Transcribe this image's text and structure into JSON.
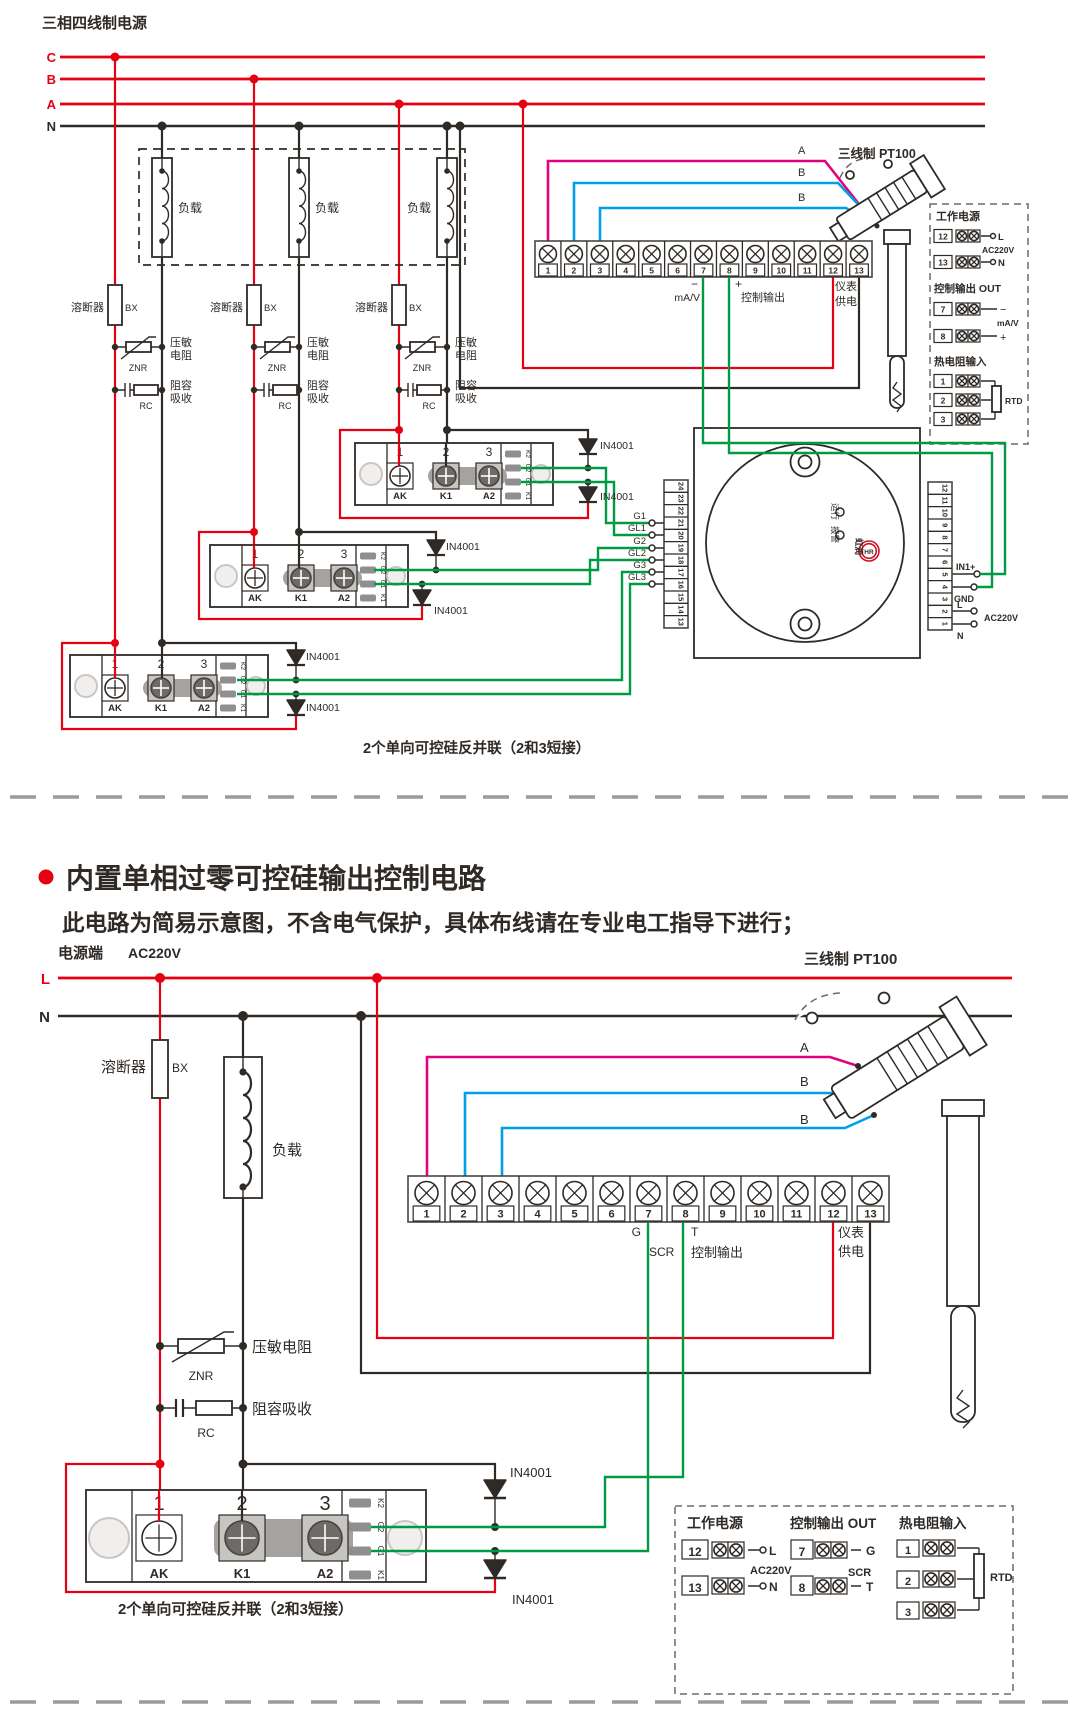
{
  "colors": {
    "red": "#e60012",
    "magenta": "#e4007f",
    "blue": "#00a0e9",
    "green": "#009a44",
    "ink": "#2f2a26"
  },
  "top": {
    "title": "三相四线制电源",
    "phase_c": "C",
    "phase_b": "B",
    "phase_a": "A",
    "neutral": "N",
    "load": "负载",
    "fuse": "溶断器",
    "fuse_code": "BX",
    "znr1": "压敏",
    "znr2": "电阻",
    "znr_code": "ZNR",
    "rc1": "阻容",
    "rc2": "吸收",
    "rc_code": "RC",
    "diode": "IN4001",
    "module_numbers": [
      "1",
      "2",
      "3"
    ],
    "module_names": [
      "AK",
      "K1",
      "A2"
    ],
    "module_side": [
      "K2",
      "G2",
      "G1",
      "K1"
    ],
    "strip_numbers": [
      "1",
      "2",
      "3",
      "4",
      "5",
      "6",
      "7",
      "8",
      "9",
      "10",
      "11",
      "12",
      "13"
    ],
    "minus": "−",
    "plus": "+",
    "ma_v": "mA/V",
    "control_out": "控制输出",
    "meter1": "仪表",
    "meter2": "供电",
    "wire_a": "A",
    "wire_b1": "B",
    "wire_b2": "B",
    "sensor": "三线制 PT100",
    "gates": [
      "G1",
      "GL1",
      "G2",
      "GL2",
      "G3",
      "GL3"
    ],
    "ctl_left": [
      "24",
      "23",
      "22",
      "21",
      "20",
      "19",
      "18",
      "17",
      "16",
      "15",
      "14",
      "13"
    ],
    "ctl_right": [
      "12",
      "11",
      "10",
      "9",
      "8",
      "7",
      "6",
      "5",
      "4",
      "3",
      "2",
      "1"
    ],
    "run": "运行",
    "alarm": "报警",
    "brand": "虹润",
    "brand_logo": "HR",
    "in1": "IN1+",
    "gnd": "GND",
    "l": "L",
    "ac220": "AC220V",
    "n": "N",
    "panel": {
      "power": "工作电源",
      "out": "控制输出 OUT",
      "rtd_in": "热电阻输入",
      "n12": "12",
      "n13": "13",
      "n7": "7",
      "n8": "8",
      "r1": "1",
      "r2": "2",
      "r3": "3",
      "l": "L",
      "n": "N",
      "ac": "AC220V",
      "minus": "−",
      "plus": "+",
      "ma_v": "mA/V",
      "rtd": "RTD"
    },
    "caption": "2个单向可控硅反并联（2和3短接）"
  },
  "middle": {
    "heading": "内置单相过零可控硅输出控制电路",
    "note": "此电路为简易示意图，不含电气保护，具体布线请在专业电工指导下进行；"
  },
  "bottom": {
    "source": "电源端",
    "voltage": "AC220V",
    "line_l": "L",
    "line_n": "N",
    "fuse": "溶断器",
    "fuse_code": "BX",
    "load": "负载",
    "znr": "压敏电阻",
    "znr_code": "ZNR",
    "rc": "阻容吸收",
    "rc_code": "RC",
    "strip_numbers": [
      "1",
      "2",
      "3",
      "4",
      "5",
      "6",
      "7",
      "8",
      "9",
      "10",
      "11",
      "12",
      "13"
    ],
    "g": "G",
    "scr": "SCR",
    "t": "T",
    "control_out": "控制输出",
    "meter1": "仪表",
    "meter2": "供电",
    "wire_a": "A",
    "wire_b1": "B",
    "wire_b2": "B",
    "sensor": "三线制 PT100",
    "module_numbers": [
      "1",
      "2",
      "3"
    ],
    "module_names": [
      "AK",
      "K1",
      "A2"
    ],
    "module_side": [
      "K2",
      "G2",
      "G1",
      "K1"
    ],
    "diode": "IN4001",
    "caption": "2个单向可控硅反并联（2和3短接）",
    "panel": {
      "power": "工作电源",
      "out": "控制输出 OUT",
      "rtd_in": "热电阻输入",
      "n12": "12",
      "n13": "13",
      "l": "L",
      "n": "N",
      "ac": "AC220V",
      "n7": "7",
      "n8": "8",
      "g": "G",
      "scr": "SCR",
      "t": "T",
      "r1": "1",
      "r2": "2",
      "r3": "3",
      "rtd": "RTD"
    }
  }
}
